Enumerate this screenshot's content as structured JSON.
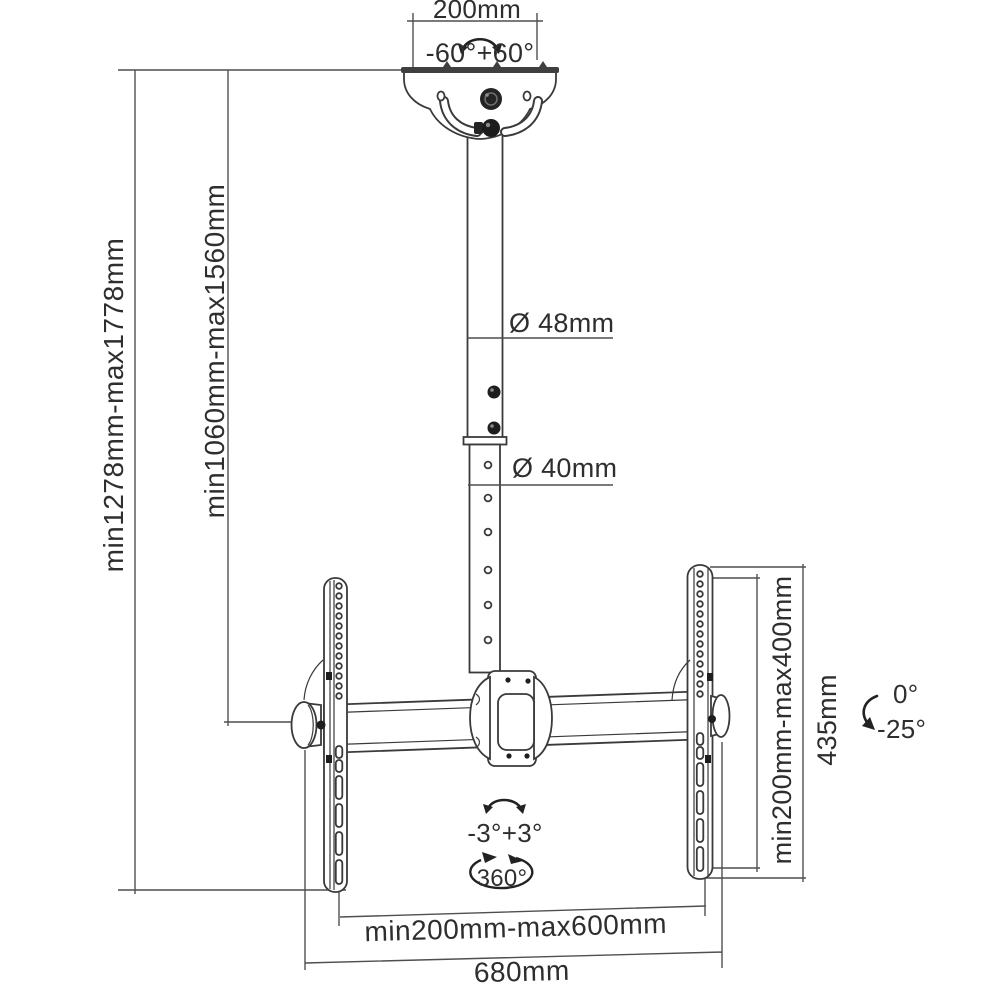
{
  "figure": {
    "subject": "TV ceiling mount bracket dimensional diagram",
    "background": "#ffffff",
    "line_color": "#3f3f3f",
    "text_color": "#2e2e2e",
    "labels": {
      "ceiling_plate_width": "200mm",
      "swivel_range": "-60°+60°",
      "upper_pole_diameter": "Ø 48mm",
      "lower_pole_diameter": "Ø 40mm",
      "overall_height": "min1278mm-max1778mm",
      "pole_height": "min1060mm-max1560mm",
      "vesa_height_range": "min200mm-max400mm",
      "bracket_height": "435mm",
      "tilt_max": "0°",
      "tilt_min": "-25°",
      "level_adjust_range": "-3°+3°",
      "rotation_full": "360°",
      "vesa_width_range": "min200mm-max600mm",
      "crossbar_width": "680mm"
    }
  }
}
